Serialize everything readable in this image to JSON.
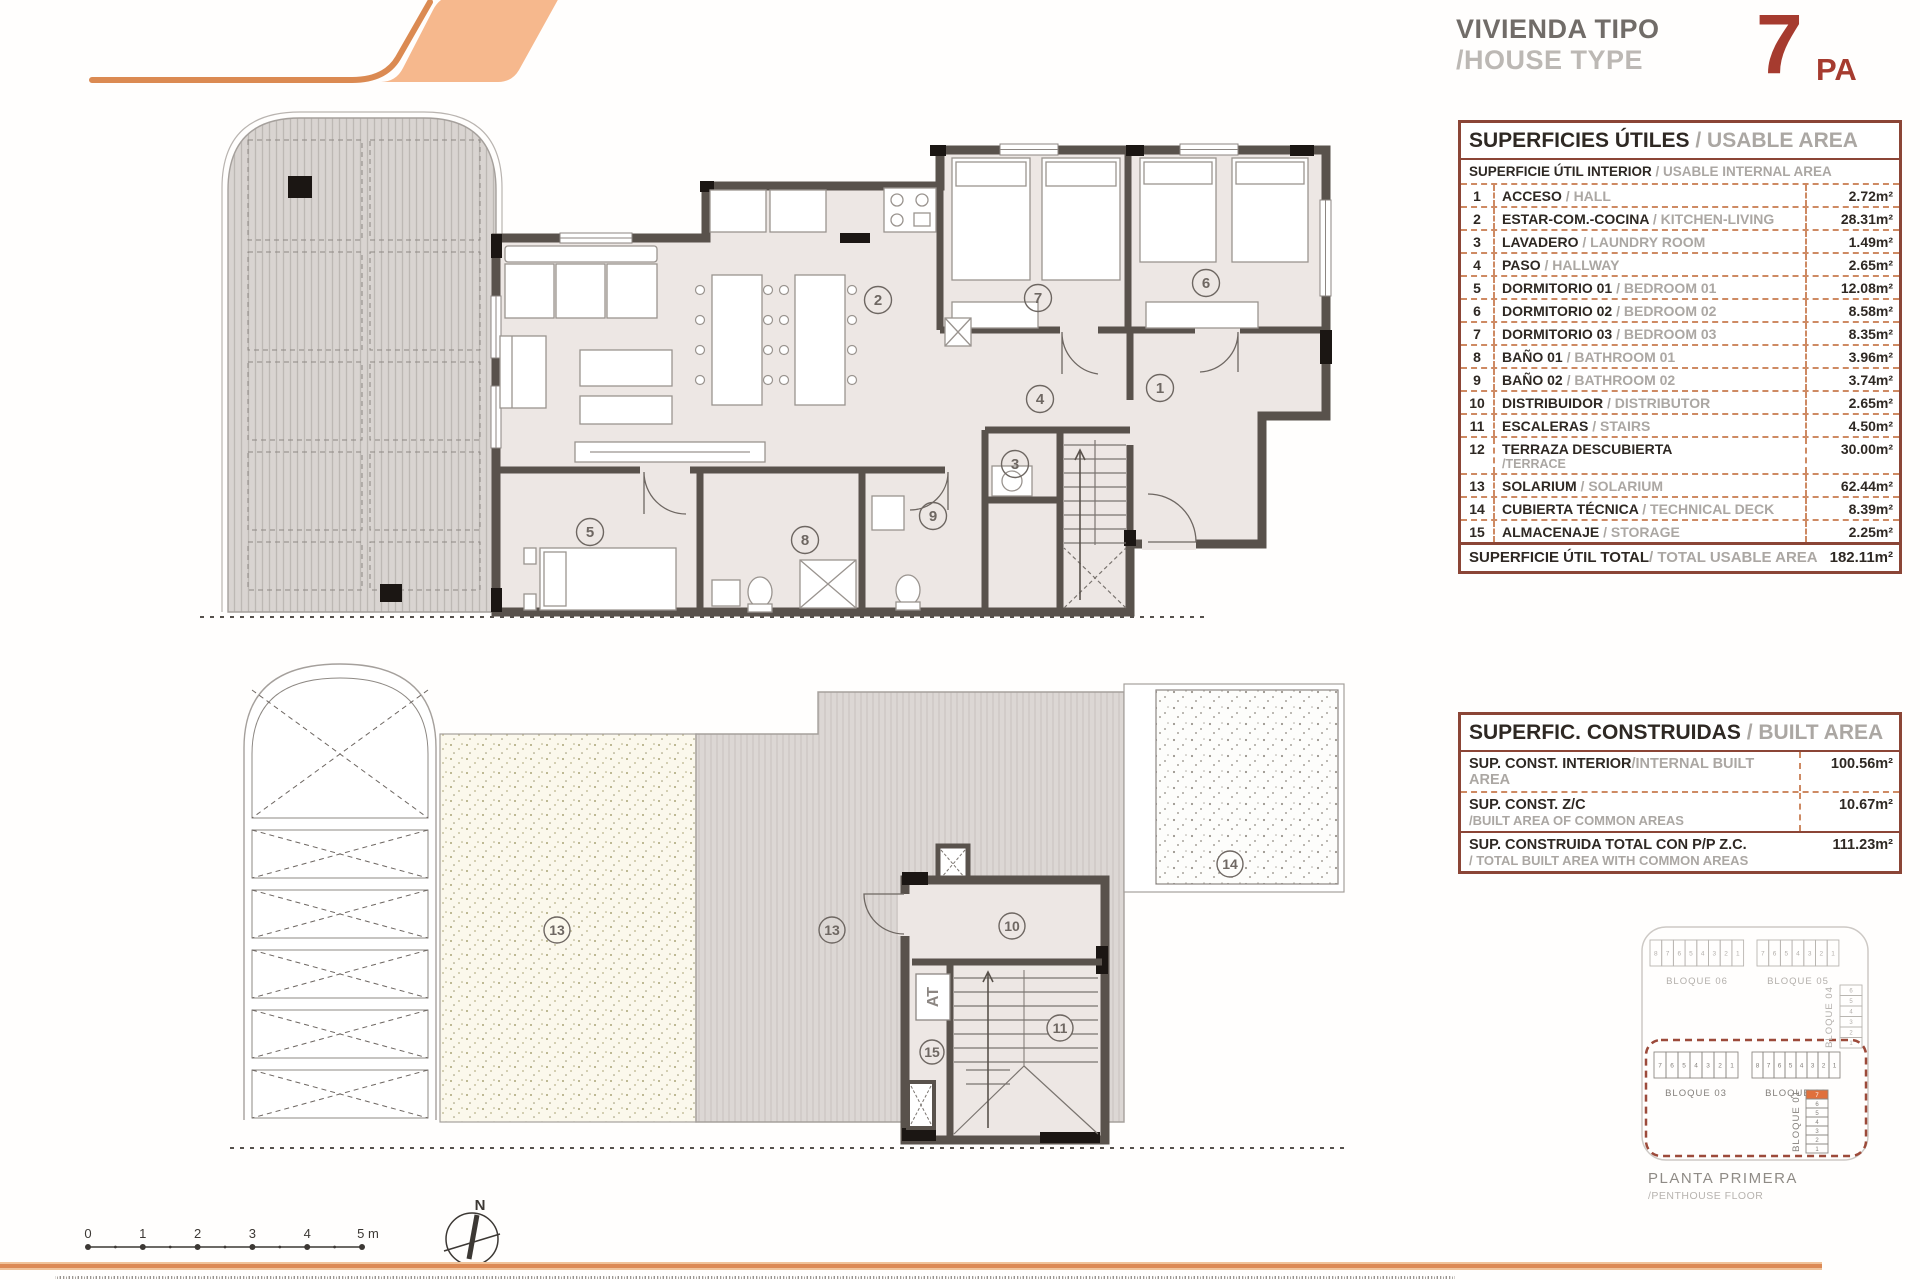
{
  "header": {
    "title_line1": "VIVIENDA TIPO",
    "title_line2": "/HOUSE TYPE",
    "type_number": "7",
    "type_suffix": "PA"
  },
  "usable_table": {
    "title": "SUPERFICIES ÚTILES",
    "title_en": " / USABLE AREA",
    "subtitle": "SUPERFICIE ÚTIL INTERIOR",
    "subtitle_en": " / USABLE INTERNAL AREA",
    "rows": [
      {
        "num": "1",
        "name": "ACCESO",
        "name_en": "/ HALL",
        "value": "2.72m²"
      },
      {
        "num": "2",
        "name": "ESTAR-COM.-COCINA",
        "name_en": "/ KITCHEN-LIVING",
        "value": "28.31m²"
      },
      {
        "num": "3",
        "name": "LAVADERO",
        "name_en": "/ LAUNDRY ROOM",
        "value": "1.49m²"
      },
      {
        "num": "4",
        "name": "PASO",
        "name_en": "/ HALLWAY",
        "value": "2.65m²"
      },
      {
        "num": "5",
        "name": "DORMITORIO 01",
        "name_en": "/ BEDROOM 01",
        "value": "12.08m²"
      },
      {
        "num": "6",
        "name": "DORMITORIO 02",
        "name_en": "/ BEDROOM 02",
        "value": "8.58m²"
      },
      {
        "num": "7",
        "name": "DORMITORIO 03",
        "name_en": "/ BEDROOM 03",
        "value": "8.35m²"
      },
      {
        "num": "8",
        "name": "BAÑO 01",
        "name_en": "/ BATHROOM 01",
        "value": "3.96m²"
      },
      {
        "num": "9",
        "name": "BAÑO 02",
        "name_en": "/ BATHROOM 02",
        "value": "3.74m²"
      },
      {
        "num": "10",
        "name": "DISTRIBUIDOR",
        "name_en": "/ DISTRIBUTOR",
        "value": "2.65m²"
      },
      {
        "num": "11",
        "name": "ESCALERAS",
        "name_en": "/ STAIRS",
        "value": "4.50m²"
      },
      {
        "num": "12",
        "name": "TERRAZA DESCUBIERTA",
        "name_en": "",
        "name_line2": "/TERRACE",
        "value": "30.00m²"
      },
      {
        "num": "13",
        "name": "SOLARIUM",
        "name_en": "/ SOLARIUM",
        "value": "62.44m²"
      },
      {
        "num": "14",
        "name": "CUBIERTA TÉCNICA",
        "name_en": "/ TECHNICAL DECK",
        "value": "8.39m²"
      },
      {
        "num": "15",
        "name": "ALMACENAJE",
        "name_en": "/ STORAGE",
        "value": "2.25m²"
      }
    ],
    "total_label": "SUPERFICIE ÚTIL TOTAL",
    "total_label_en": " / TOTAL USABLE AREA",
    "total_value": "182.11m²"
  },
  "built_table": {
    "title": "SUPERFIC. CONSTRUIDAS",
    "title_en": " / BUILT AREA",
    "rows": [
      {
        "label": "SUP. CONST. INTERIOR",
        "label_en": "/INTERNAL BUILT AREA",
        "label2": "",
        "value": "100.56m²"
      },
      {
        "label": "SUP. CONST. Z/C",
        "label_en": "",
        "label2": "/BUILT AREA OF COMMON AREAS",
        "value": "10.67m²"
      },
      {
        "label": "SUP. CONSTRUIDA TOTAL CON P/P Z.C.",
        "label_en": "",
        "label2": "/ TOTAL BUILT AREA WITH COMMON AREAS",
        "value": "111.23m²"
      }
    ]
  },
  "plan_top": {
    "rooms": {
      "r1": "1",
      "r2": "2",
      "r3": "3",
      "r4": "4",
      "r5": "5",
      "r6": "6",
      "r7": "7",
      "r8": "8",
      "r9": "9"
    }
  },
  "plan_bottom": {
    "rooms": {
      "r10": "10",
      "r11": "11",
      "r13a": "13",
      "r13b": "13",
      "r14": "14",
      "r15": "15"
    },
    "attic_label": "AT"
  },
  "site_plan": {
    "blocks": [
      {
        "name": "BLOQUE 06",
        "cells": [
          "8",
          "7",
          "6",
          "5",
          "4",
          "3",
          "2",
          "1"
        ]
      },
      {
        "name": "BLOQUE 05",
        "cells": [
          "7",
          "6",
          "5",
          "4",
          "3",
          "2",
          "1"
        ]
      },
      {
        "name": "BLOQUE 04",
        "cells": [
          "6",
          "5",
          "4",
          "3",
          "2",
          "1"
        ]
      },
      {
        "name": "BLOQUE 03",
        "cells": [
          "7",
          "6",
          "5",
          "4",
          "3",
          "2",
          "1"
        ]
      },
      {
        "name": "BLOQUE 02",
        "cells": [
          "8",
          "7",
          "6",
          "5",
          "4",
          "3",
          "2",
          "1"
        ]
      },
      {
        "name": "BLOQUE 01",
        "cells": [
          "7",
          "6",
          "5",
          "4",
          "3",
          "2",
          "1"
        ]
      }
    ],
    "highlight_unit": "7",
    "highlight_color": "#E0703C",
    "caption": "PLANTA PRIMERA",
    "caption_en": "/PENTHOUSE FLOOR"
  },
  "scale_bar": {
    "labels": [
      "0",
      "1",
      "2",
      "3",
      "4",
      "5 m"
    ]
  },
  "compass": {
    "label": "N"
  },
  "colors": {
    "accent_orange": "#DC8A55",
    "logo_fill": "#F6B88D",
    "brick_red": "#A63B2F",
    "table_border": "#8B4536",
    "wall": "#59524C"
  }
}
